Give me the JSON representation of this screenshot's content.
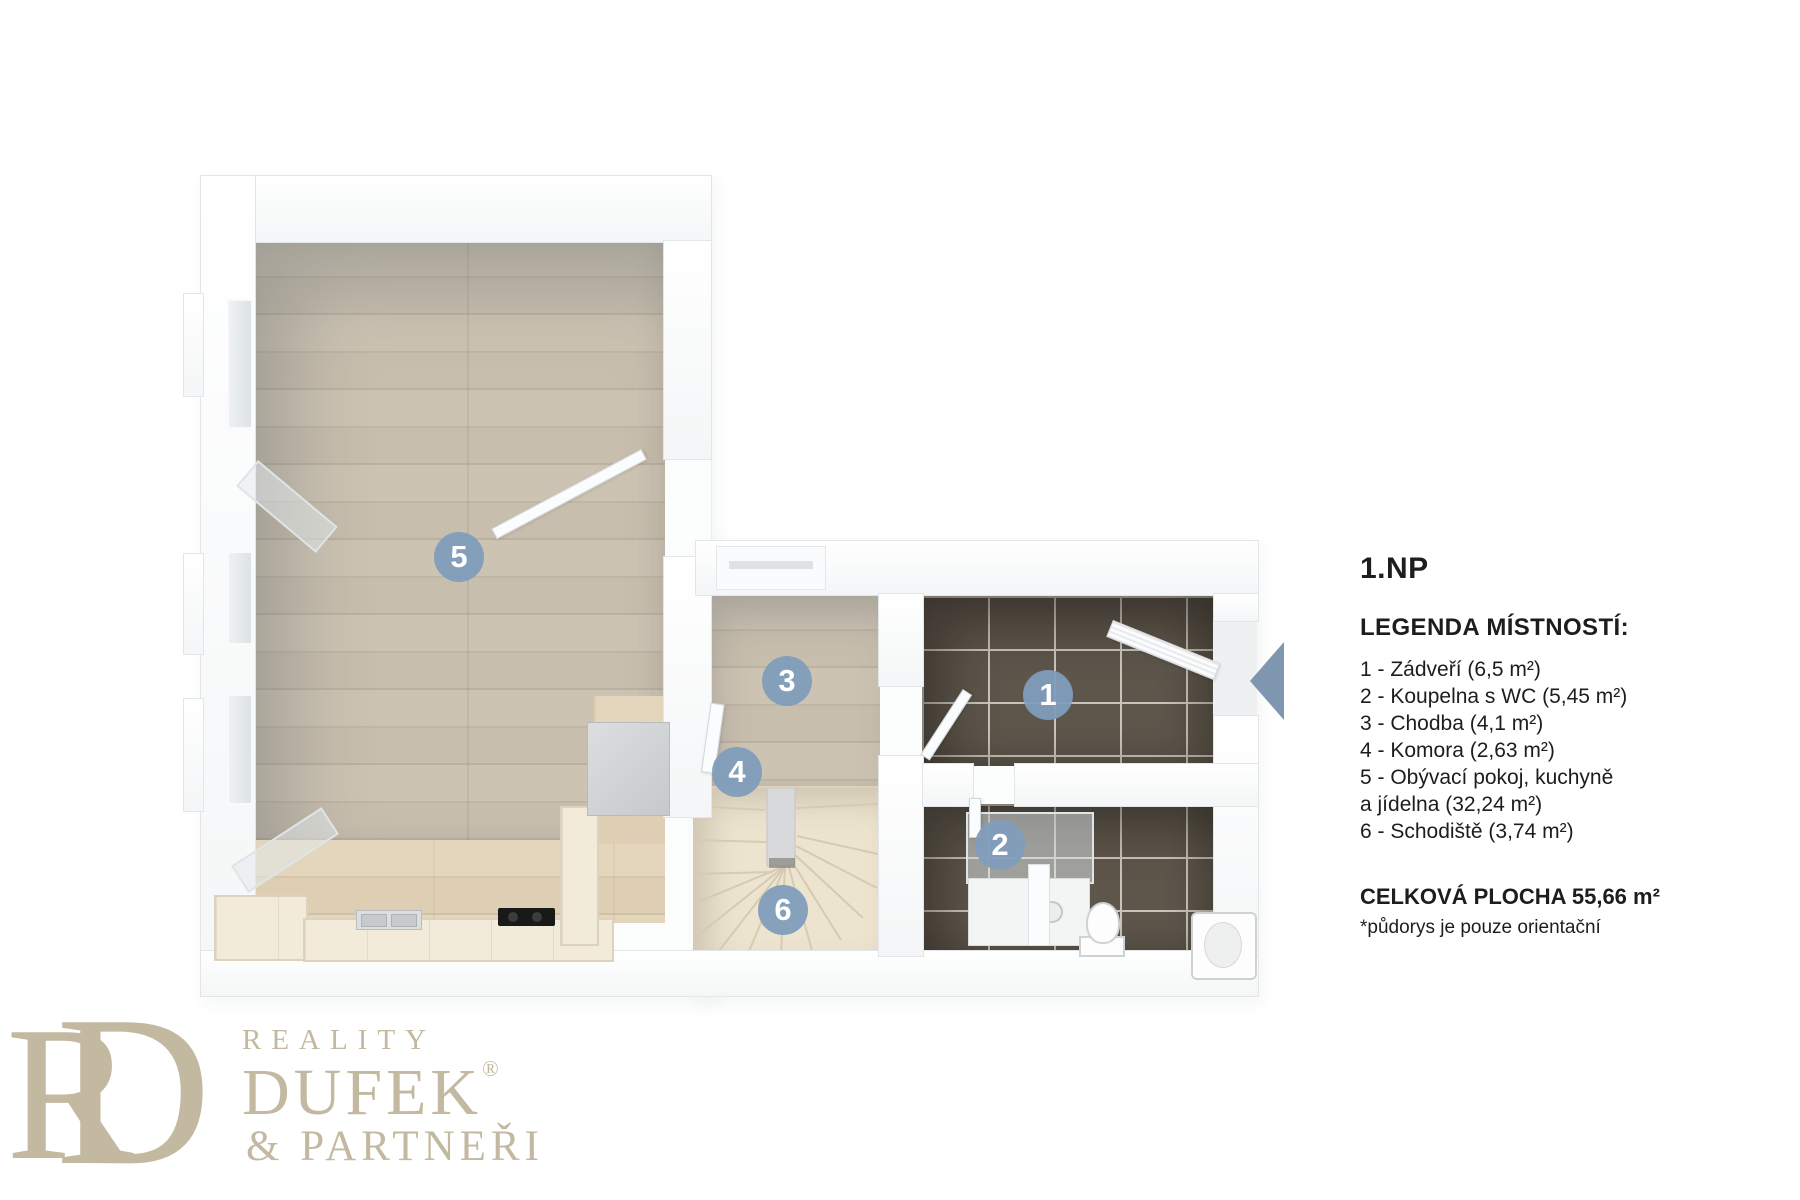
{
  "floor_title": "1.NP",
  "legend": {
    "heading": "LEGENDA MÍSTNOSTÍ:",
    "lines": [
      "1 - Zádveří (6,5 m²)",
      "2 - Koupelna s WC (5,45 m²)",
      "3 - Chodba (4,1 m²)",
      "4 - Komora (2,63 m²)",
      "5 - Obývací pokoj, kuchyně",
      "a jídelna (32,24 m²)",
      "6 - Schodiště (3,74 m²)"
    ],
    "total": "CELKOVÁ PLOCHA 55,66 m²",
    "note": "*půdorys je pouze orientační"
  },
  "rooms": [
    {
      "number": "1",
      "name": "Zádveří",
      "area": "6,5 m²"
    },
    {
      "number": "2",
      "name": "Koupelna s WC",
      "area": "5,45 m²"
    },
    {
      "number": "3",
      "name": "Chodba",
      "area": "4,1 m²"
    },
    {
      "number": "4",
      "name": "Komora",
      "area": "2,63 m²"
    },
    {
      "number": "5",
      "name": "Obývací pokoj, kuchyně a jídelna",
      "area": "32,24 m²"
    },
    {
      "number": "6",
      "name": "Schodiště",
      "area": "3,74 m²"
    }
  ],
  "entrance": {
    "arrow_direction": "left"
  },
  "logo": {
    "monogram_r": "R",
    "monogram_d": "D",
    "reality": "REALITY",
    "dufek": "DUFEK",
    "registered": "®",
    "partneri": "& PARTNEŘI"
  },
  "colors": {
    "badge_blue": "#7f9dbb",
    "arrow_blue": "#7e96af",
    "logo_beige": "#c3b9a0",
    "tile_floor": "#5e564b",
    "wood_floor": "#c9bfae",
    "stair_floor": "#ede4d0",
    "wall_white": "#ffffff"
  }
}
